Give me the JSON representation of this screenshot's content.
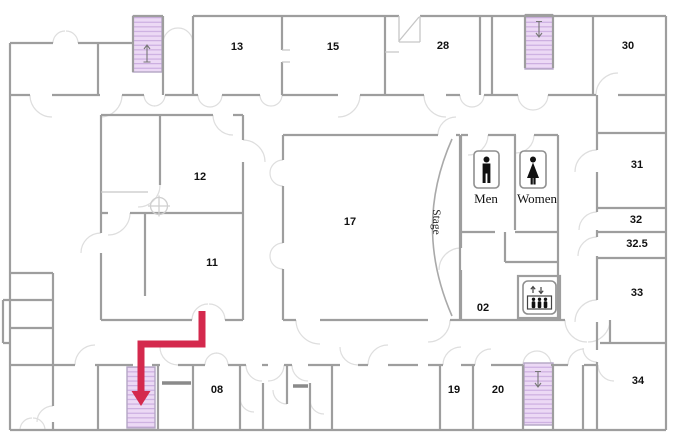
{
  "plan": {
    "type": "building-floor-plan",
    "rooms": [
      {
        "id": "13",
        "label": "13"
      },
      {
        "id": "15",
        "label": "15"
      },
      {
        "id": "28",
        "label": "28"
      },
      {
        "id": "30",
        "label": "30"
      },
      {
        "id": "12",
        "label": "12"
      },
      {
        "id": "17",
        "label": "17"
      },
      {
        "id": "31",
        "label": "31"
      },
      {
        "id": "32",
        "label": "32"
      },
      {
        "id": "32.5",
        "label": "32.5"
      },
      {
        "id": "33",
        "label": "33"
      },
      {
        "id": "11",
        "label": "11"
      },
      {
        "id": "02",
        "label": "02"
      },
      {
        "id": "08",
        "label": "08"
      },
      {
        "id": "19",
        "label": "19"
      },
      {
        "id": "20",
        "label": "20"
      },
      {
        "id": "34",
        "label": "34"
      }
    ],
    "labels": {
      "stage": "Stage",
      "men": "Men",
      "women": "Women"
    },
    "icons": [
      "men-restroom-icon",
      "women-restroom-icon",
      "elevator-icon",
      "stairs-top-left",
      "stairs-top-right",
      "stairs-bottom-left",
      "stairs-bottom-right",
      "route-arrow",
      "column-symbol"
    ],
    "colors": {
      "wall": "#9e9e9e",
      "wall-light": "#c6c6c6",
      "door-arc": "#dedede",
      "stairs-fill": "#ecd9f5",
      "stairs-hatch": "#c9aade",
      "stairs-border": "#b3a6c4",
      "route": "#d4294d",
      "label": "#111111",
      "background": "#ffffff"
    }
  }
}
